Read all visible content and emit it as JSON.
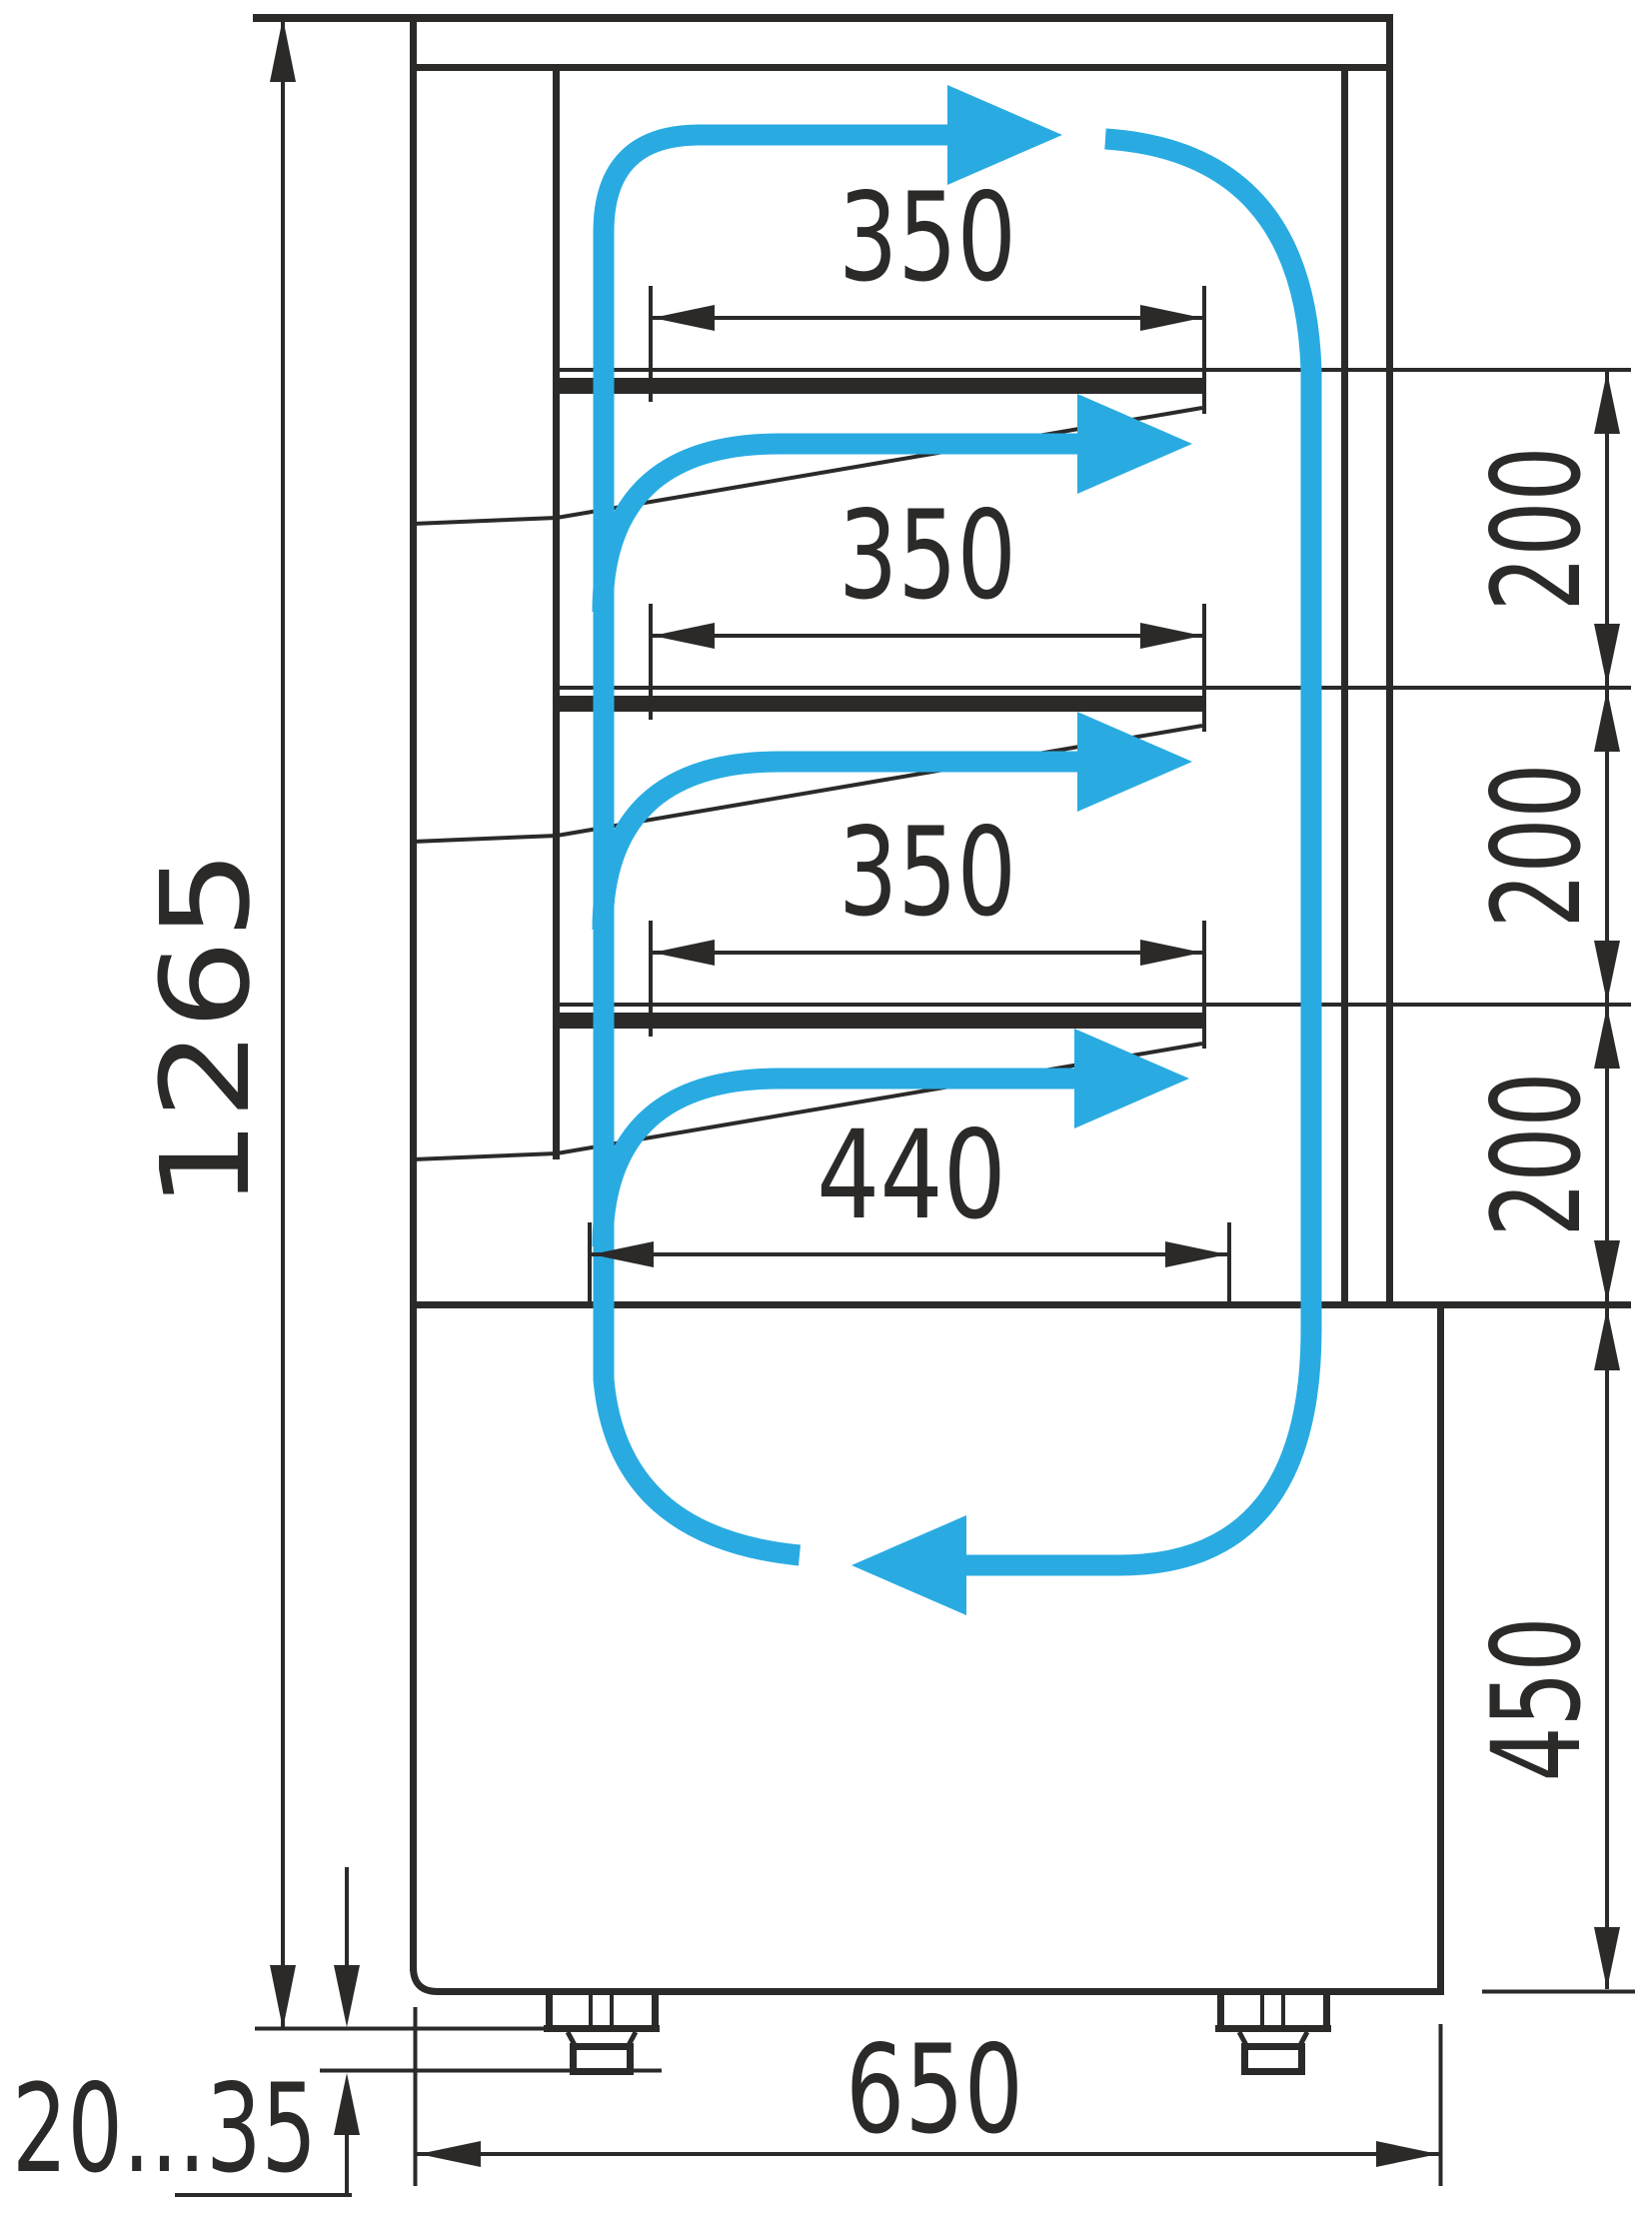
{
  "diagram": {
    "title": "Refrigerated display case side section with air circulation",
    "colors": {
      "line": "#2b2a29",
      "airflow": "#29ABE2",
      "background": "#ffffff"
    },
    "dimensions": {
      "overall_height": "1265",
      "shelf_depths": [
        "350",
        "350",
        "350"
      ],
      "bottom_deck_depth": "440",
      "shelf_spacings": [
        "200",
        "200",
        "200"
      ],
      "base_height": "450",
      "overall_depth": "650",
      "foot_adjustment_range": "20...35"
    }
  }
}
